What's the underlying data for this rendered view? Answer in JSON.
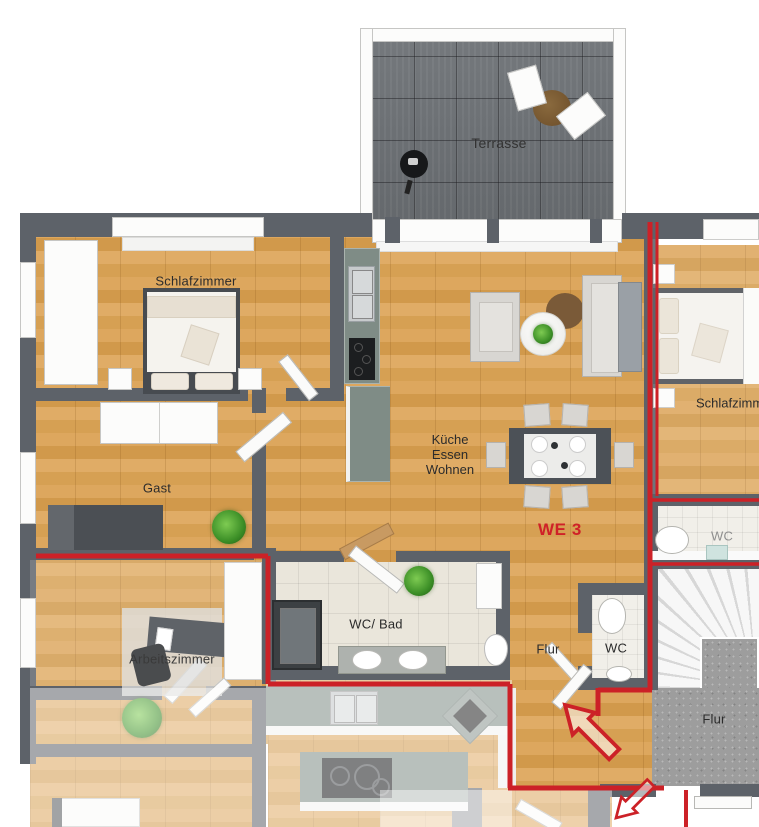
{
  "unit": {
    "label": "WE 3"
  },
  "rooms": {
    "terrasse": {
      "label": "Terrasse"
    },
    "schlafzimmer_left": {
      "label": "Schlafzimmer"
    },
    "schlafzimmer_right": {
      "label": "Schlafzimmer"
    },
    "gast": {
      "label": "Gast"
    },
    "wohnbereich": {
      "line1": "Küche",
      "line2": "Essen",
      "line3": "Wohnen"
    },
    "arbeitszimmer": {
      "label": "Arbeitszimmer"
    },
    "wc_bad": {
      "label": "WC/ Bad"
    },
    "flur_wohnung": {
      "label": "Flur"
    },
    "wc_klein": {
      "label": "WC"
    },
    "wc_rechts": {
      "label": "WC"
    },
    "flur_treppenhaus": {
      "label": "Flur"
    }
  },
  "colors": {
    "apartment_boundary": "#cc2127",
    "unit_label": "#cf2128",
    "walls": "#5d6269",
    "wood_floor": "#d7a158",
    "terrace_tiles": "#6b6f73",
    "bath_tiles": "#eae6db",
    "stair_hall_floor": "#9d9d9d",
    "kitchen_counter": "#7f8c86"
  }
}
